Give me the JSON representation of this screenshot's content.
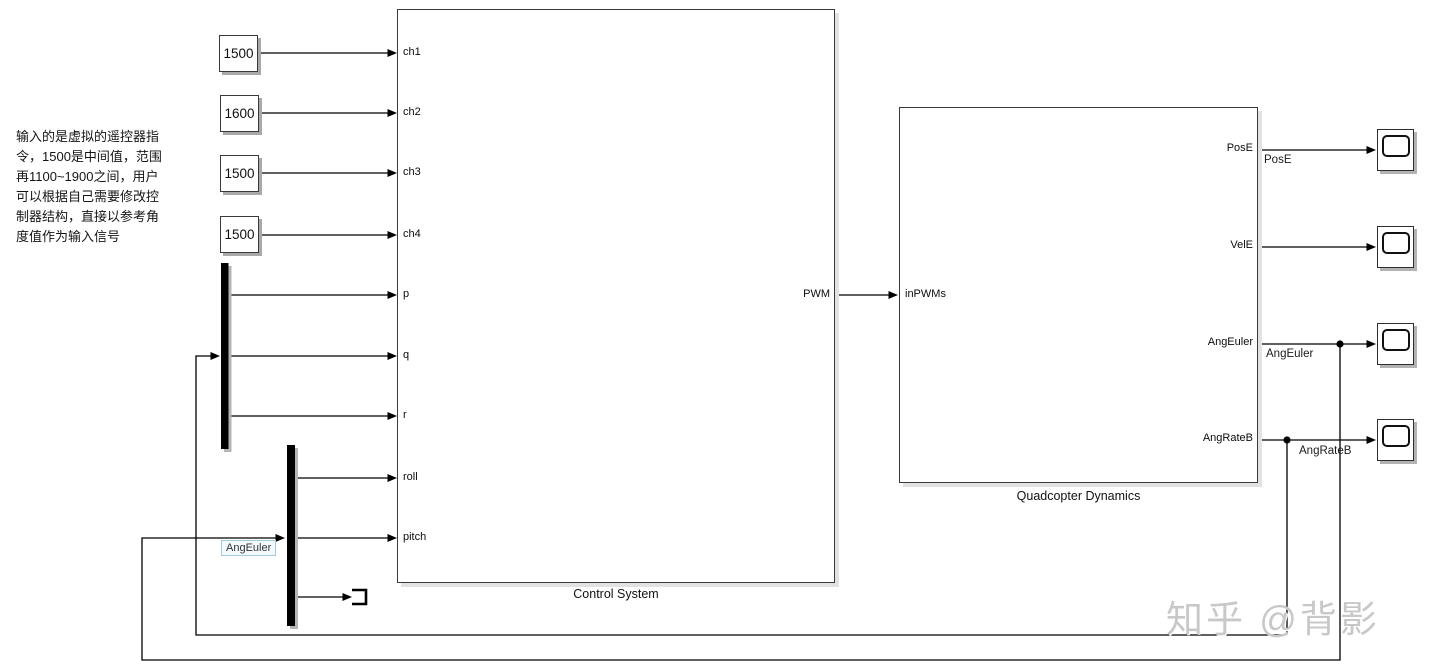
{
  "annotation": {
    "lines": [
      "输入的是虚拟的遥控器指",
      "令，1500是中间值，范围",
      "再1100~1900之间，用户",
      "可以根据自己需要修改控",
      "制器结构，直接以参考角",
      "度值作为输入信号"
    ]
  },
  "constants": [
    "1500",
    "1600",
    "1500",
    "1500"
  ],
  "control_system": {
    "title": "Control System",
    "ports_in": [
      "ch1",
      "ch2",
      "ch3",
      "ch4",
      "p",
      "q",
      "r",
      "roll",
      "pitch"
    ],
    "ports_out": [
      "PWM"
    ]
  },
  "quadcopter": {
    "title": "Quadcopter Dynamics",
    "ports_in": [
      "inPWMs"
    ],
    "ports_out": [
      "PosE",
      "VelE",
      "AngEuler",
      "AngRateB"
    ]
  },
  "wire_labels": {
    "pose": "PosE",
    "ang_euler": "AngEuler",
    "ang_rate_b": "AngRateB",
    "ang_euler_tag": "AngEuler"
  },
  "watermark": "知乎 @背影",
  "colors": {
    "wire": "#000000",
    "block_border": "#3a3a3a",
    "shadow": "#a9a9a9",
    "signal_tag_border": "#a5c9de",
    "watermark_gray": "#c8c8c8"
  }
}
